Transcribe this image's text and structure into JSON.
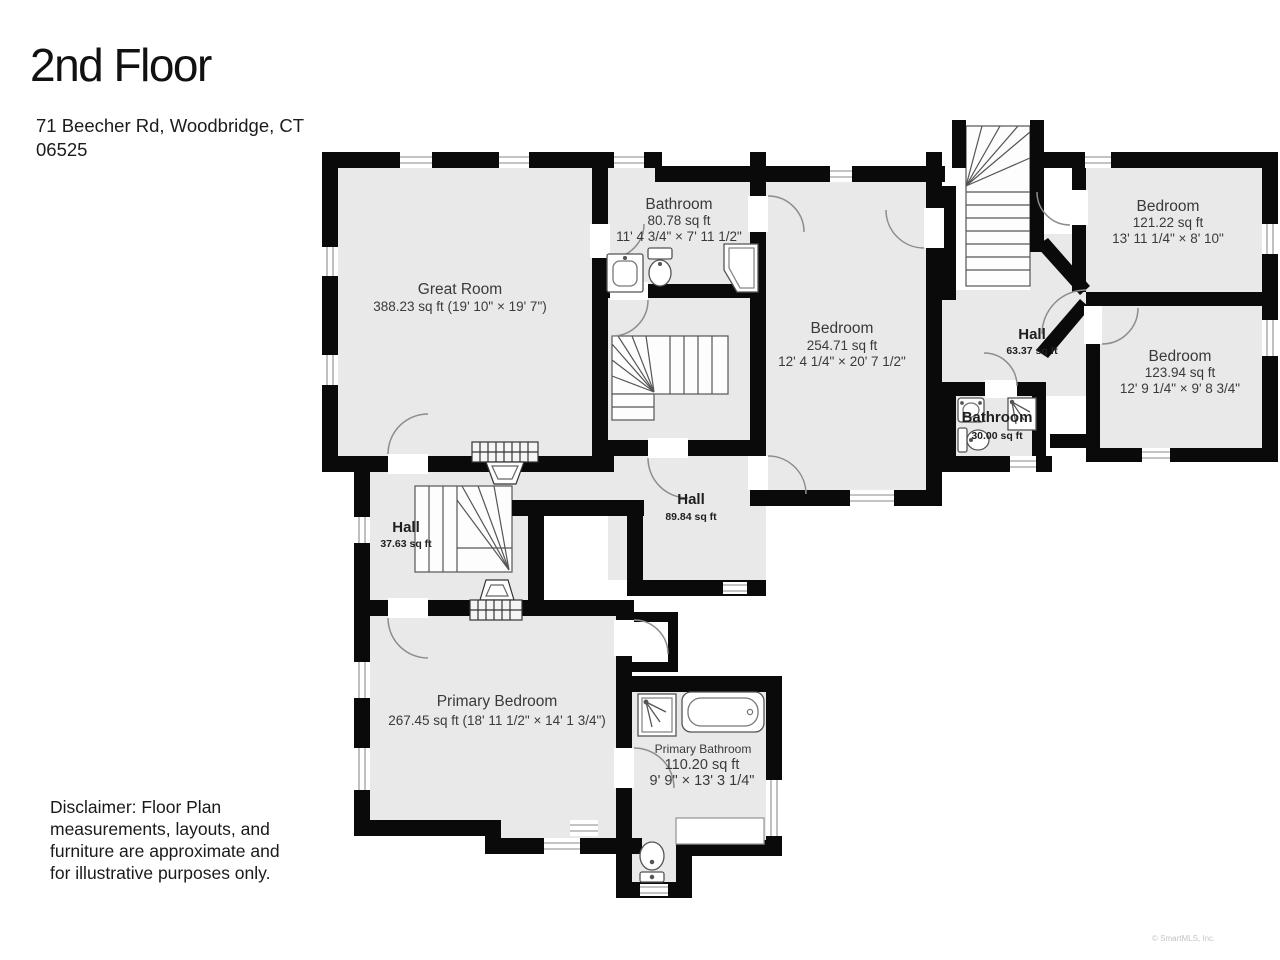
{
  "header": {
    "title": "2nd Floor",
    "address_line1": "71 Beecher Rd, Woodbridge, CT",
    "address_line2": "06525"
  },
  "rooms": {
    "great_room": {
      "name": "Great Room",
      "details": "388.23 sq ft (19' 10\" × 19' 7\")"
    },
    "bathroom_top": {
      "name": "Bathroom",
      "area": "80.78 sq ft",
      "dims": "11' 4 3/4\" × 7' 11 1/2\""
    },
    "bedroom_center": {
      "name": "Bedroom",
      "area": "254.71 sq ft",
      "dims": "12' 4 1/4\" × 20' 7 1/2\""
    },
    "bedroom_top_right": {
      "name": "Bedroom",
      "area": "121.22 sq ft",
      "dims": "13' 11 1/4\" × 8' 10\""
    },
    "bedroom_right": {
      "name": "Bedroom",
      "area": "123.94 sq ft",
      "dims": "12' 9 1/4\" × 9' 8 3/4\""
    },
    "hall_right": {
      "name": "Hall",
      "area": "63.37 sq ft"
    },
    "bathroom_small": {
      "name": "Bathroom",
      "area": "30.00 sq ft"
    },
    "hall_center": {
      "name": "Hall",
      "area": "89.84 sq ft"
    },
    "hall_left": {
      "name": "Hall",
      "area": "37.63 sq ft"
    },
    "primary_bedroom": {
      "name": "Primary Bedroom",
      "details": "267.45 sq ft (18' 11 1/2\" × 14' 1 3/4\")"
    },
    "primary_bathroom": {
      "name": "Primary Bathroom",
      "area": "110.20 sq ft",
      "dims": "9' 9\" × 13' 3 1/4\""
    }
  },
  "disclaimer": {
    "lines": [
      "Disclaimer: Floor Plan",
      "measurements, layouts, and",
      "furniture are approximate and",
      "for illustrative purposes only."
    ]
  },
  "footer": {
    "copyright": "© SmartMLS, Inc."
  },
  "colors": {
    "wall": "#0a0a0a",
    "room_fill": "#e9e9e9",
    "label": "#3a3a3a"
  }
}
